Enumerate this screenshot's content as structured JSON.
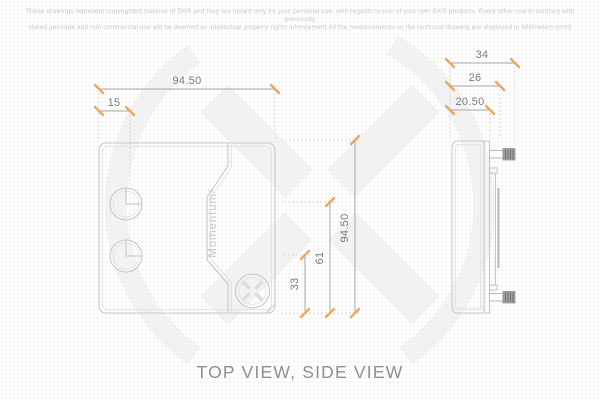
{
  "sheet": {
    "disclaimer_line1": "These drawings represent copyrighted material of EK® and they are meant only for your personal use, with regards to use of your own EK® products. Every other use in contrary with previously",
    "disclaimer_line2": "stated personal and non commercial use will be deemed as intellectual property rights infringement.All the measurements on the technical drawing are displayed in Millimeters (mm)",
    "view_title": "TOP VIEW, SIDE VIEW"
  },
  "top_view": {
    "product_label": "Momentum²",
    "dim_width": "94.50",
    "dim_port_inset": "15",
    "dim_height": "94.50",
    "dim_port1_center": "61",
    "dim_port2_center": "33"
  },
  "side_view": {
    "dim_overall_depth": "34",
    "dim_mid_depth": "26",
    "dim_body_depth": "20.50"
  },
  "colors": {
    "tick": "#F0A45C",
    "dim-line": "#A6A6A6",
    "dim-text": "#7A7A7A",
    "outline": "#C8C8C8",
    "outline-light": "#E4E4E4",
    "extension": "#D2D2D2",
    "watermark": "#F3F3F3",
    "label-light": "#C6C6C6",
    "title-text": "#8F8F8F",
    "disclaimer-text": "#C9C9C9",
    "screw": "#A3A3A3"
  }
}
